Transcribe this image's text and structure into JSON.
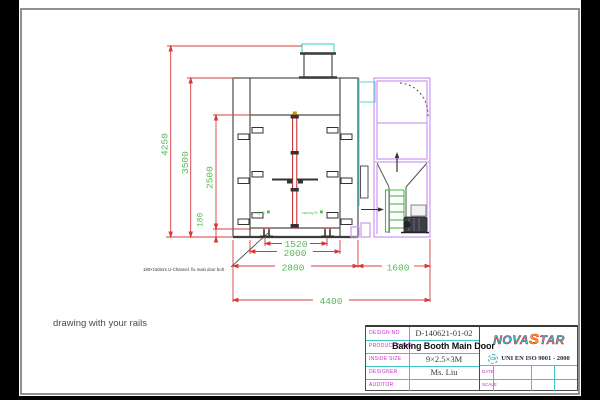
{
  "canvas": {
    "frame_color": "#000000",
    "page_border_color": "#909090",
    "note_bottom_left": "drawing with your rails"
  },
  "drawing": {
    "colors": {
      "dimension_line": "#d43c3c",
      "dimension_text": "#58b858",
      "body_line": "#4c4c4c",
      "machine_room_line": "#cf9ef0",
      "duct_cyan": "#55d4d4",
      "door_seam_red": "#c22222"
    },
    "dims": {
      "left": [
        "4250",
        "3500",
        "2500",
        "180"
      ],
      "bottom": [
        "1520",
        "2000",
        "2800",
        "1600",
        "4400"
      ]
    },
    "uchannel_note": "180×150mm U-Channel.  fix main door bolt",
    "door_marks": [
      "opening 90",
      "opening 90"
    ]
  },
  "titleblock": {
    "rows": [
      {
        "label": "DESIGN NO",
        "value": "D-140621-01-02"
      },
      {
        "label": "PRODUCT NAME",
        "value": "Baking Booth Main Door"
      },
      {
        "label": "INSIDE SIZE",
        "value": "9×2.5×3M"
      },
      {
        "label": "DESIGNER",
        "value": "Ms. Liu"
      },
      {
        "label": "AUDITOR",
        "value": ""
      }
    ],
    "date_label": "DATE",
    "scale_label": "SCALE",
    "logo": {
      "full": "NOVASTAR",
      "pre": "NOVA",
      "star": "S",
      "post": "TAR"
    },
    "cert": {
      "icon": "CE",
      "text": "UNI EN ISO 9001 - 2000"
    }
  }
}
